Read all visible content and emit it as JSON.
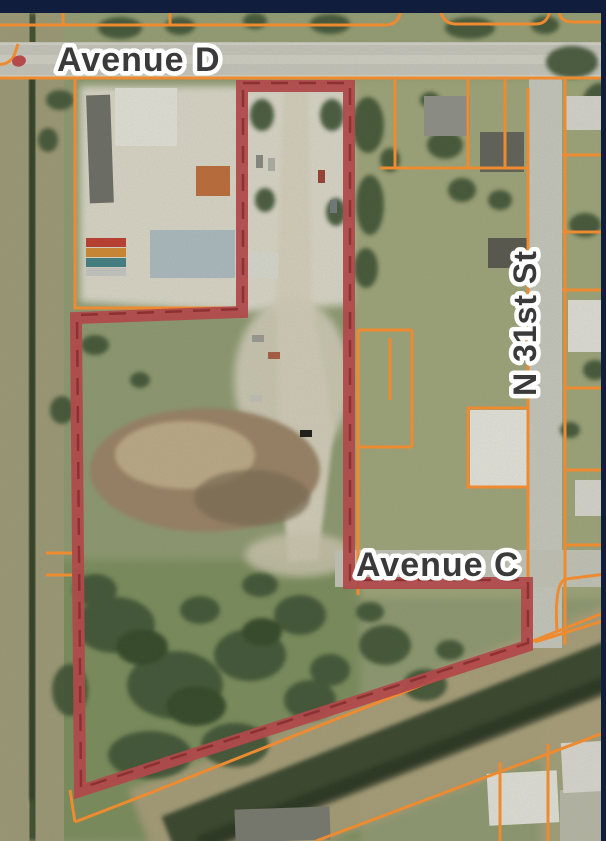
{
  "window": {
    "top_edge_color": "#101d3c",
    "right_edge_color": "#101d3c"
  },
  "map": {
    "kind": "aerial parcel map",
    "street_labels": [
      {
        "id": "avenue-d",
        "text": "Avenue D",
        "orientation": "horizontal"
      },
      {
        "id": "avenue-c",
        "text": "Avenue C",
        "orientation": "horizontal"
      },
      {
        "id": "n-31st-st",
        "text": "N 31st St",
        "orientation": "vertical"
      }
    ],
    "overlay_colors": {
      "parcel_line": "#ee8a2f",
      "subject_boundary": "#b04a4b",
      "marker_dot": "#b5494b"
    },
    "label_style": {
      "text_color": "#3a3a3a",
      "halo_color": "#ffffff"
    },
    "icons": {
      "red_dot": "red-dot-marker"
    }
  }
}
